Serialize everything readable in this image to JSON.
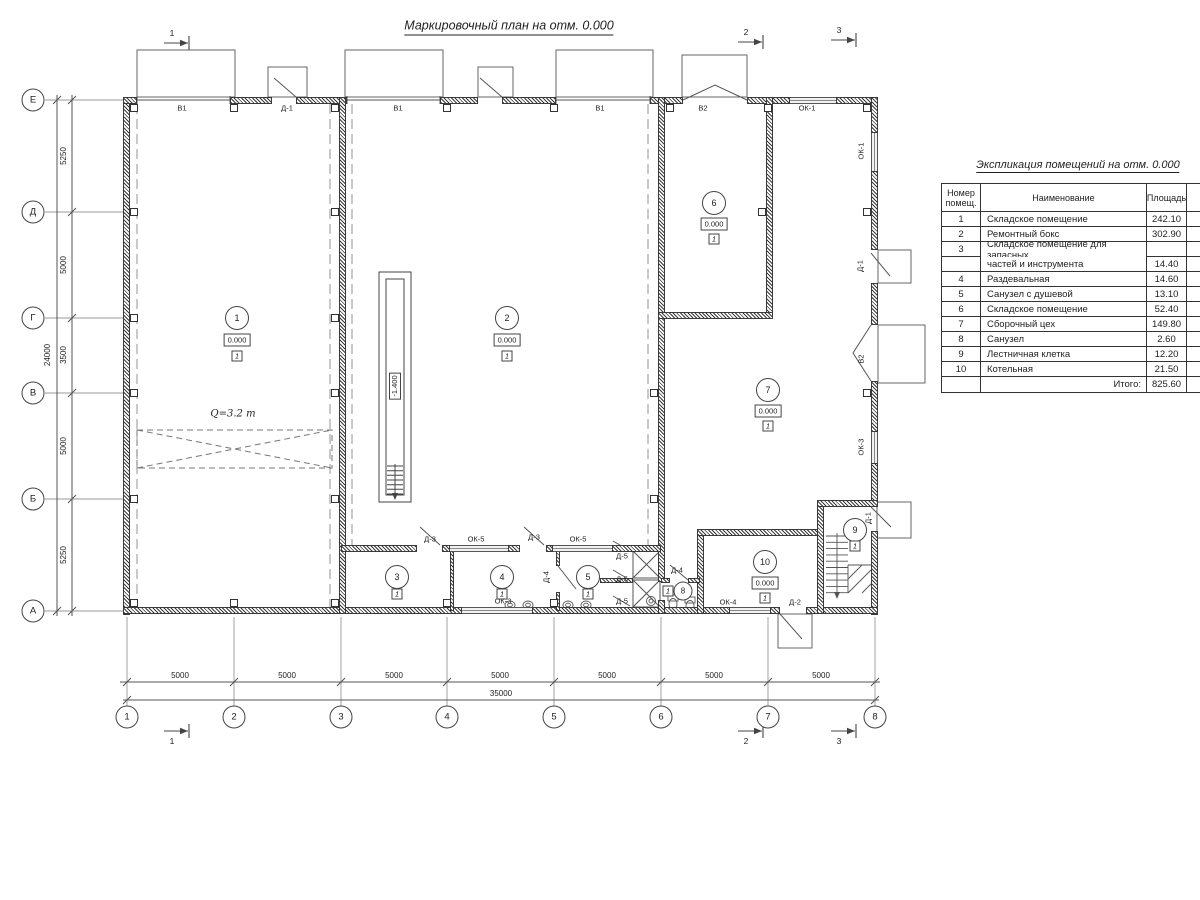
{
  "plan_title": "Маркировочный план на отм. 0.000",
  "axes": {
    "v": [
      "Е",
      "Д",
      "Г",
      "В",
      "Б",
      "А"
    ],
    "h": [
      "1",
      "2",
      "3",
      "4",
      "5",
      "6",
      "7",
      "8"
    ]
  },
  "dims": {
    "left": [
      "5250",
      "5000",
      "3500",
      "5000",
      "5250"
    ],
    "left_total": "24000",
    "bottom": [
      "5000",
      "5000",
      "5000",
      "5000",
      "5000",
      "5000",
      "5000"
    ],
    "bottom_total": "35000"
  },
  "sections": [
    "1",
    "2",
    "3"
  ],
  "marks": {
    "v1": "В1",
    "v2": "В2",
    "d1": "Д-1",
    "d2": "Д-2",
    "d3": "Д-3",
    "d4": "Д-4",
    "d5": "Д-5",
    "ok1": "ОК-1",
    "ok3": "ОК-3",
    "ok4": "ОК-4",
    "ok5": "ОК-5"
  },
  "crane": "Q=3.2 т",
  "pit": "-1.400",
  "rooms": [
    {
      "num": "1",
      "elev": "0.000",
      "floor": "1"
    },
    {
      "num": "2",
      "elev": "0.000",
      "floor": "1"
    },
    {
      "num": "3",
      "floor": "1"
    },
    {
      "num": "4",
      "floor": "1"
    },
    {
      "num": "5",
      "floor": "1"
    },
    {
      "num": "6",
      "elev": "0.000",
      "floor": "1"
    },
    {
      "num": "7",
      "elev": "0.000",
      "floor": "1"
    },
    {
      "num": "8",
      "floor": "1"
    },
    {
      "num": "9",
      "floor": "1"
    },
    {
      "num": "10",
      "elev": "0.000",
      "floor": "1"
    }
  ],
  "table": {
    "title": "Экспликация помещений на отм. 0.000",
    "col_num": "Номер\nпомещ.",
    "col_name": "Наименование",
    "col_area": "Площадь",
    "col_cat": "Ка\nпо",
    "rows": [
      {
        "num": "1",
        "name": "Складское помещение",
        "area": "242.10"
      },
      {
        "num": "2",
        "name": "Ремонтный бокс",
        "area": "302.90"
      },
      {
        "num": "3",
        "name": "Складское помещение для запасных",
        "area": ""
      },
      {
        "num": "",
        "name": "частей и инструмента",
        "area": "14.40"
      },
      {
        "num": "4",
        "name": "Раздевальная",
        "area": "14.60"
      },
      {
        "num": "5",
        "name": "Санузел с душевой",
        "area": "13.10"
      },
      {
        "num": "6",
        "name": "Складское помещение",
        "area": "52.40"
      },
      {
        "num": "7",
        "name": "Сборочный цех",
        "area": "149.80"
      },
      {
        "num": "8",
        "name": "Санузел",
        "area": "2.60"
      },
      {
        "num": "9",
        "name": "Лестничная клетка",
        "area": "12.20"
      },
      {
        "num": "10",
        "name": "Котельная",
        "area": "21.50"
      }
    ],
    "total_label": "Итого:",
    "total_value": "825.60"
  }
}
